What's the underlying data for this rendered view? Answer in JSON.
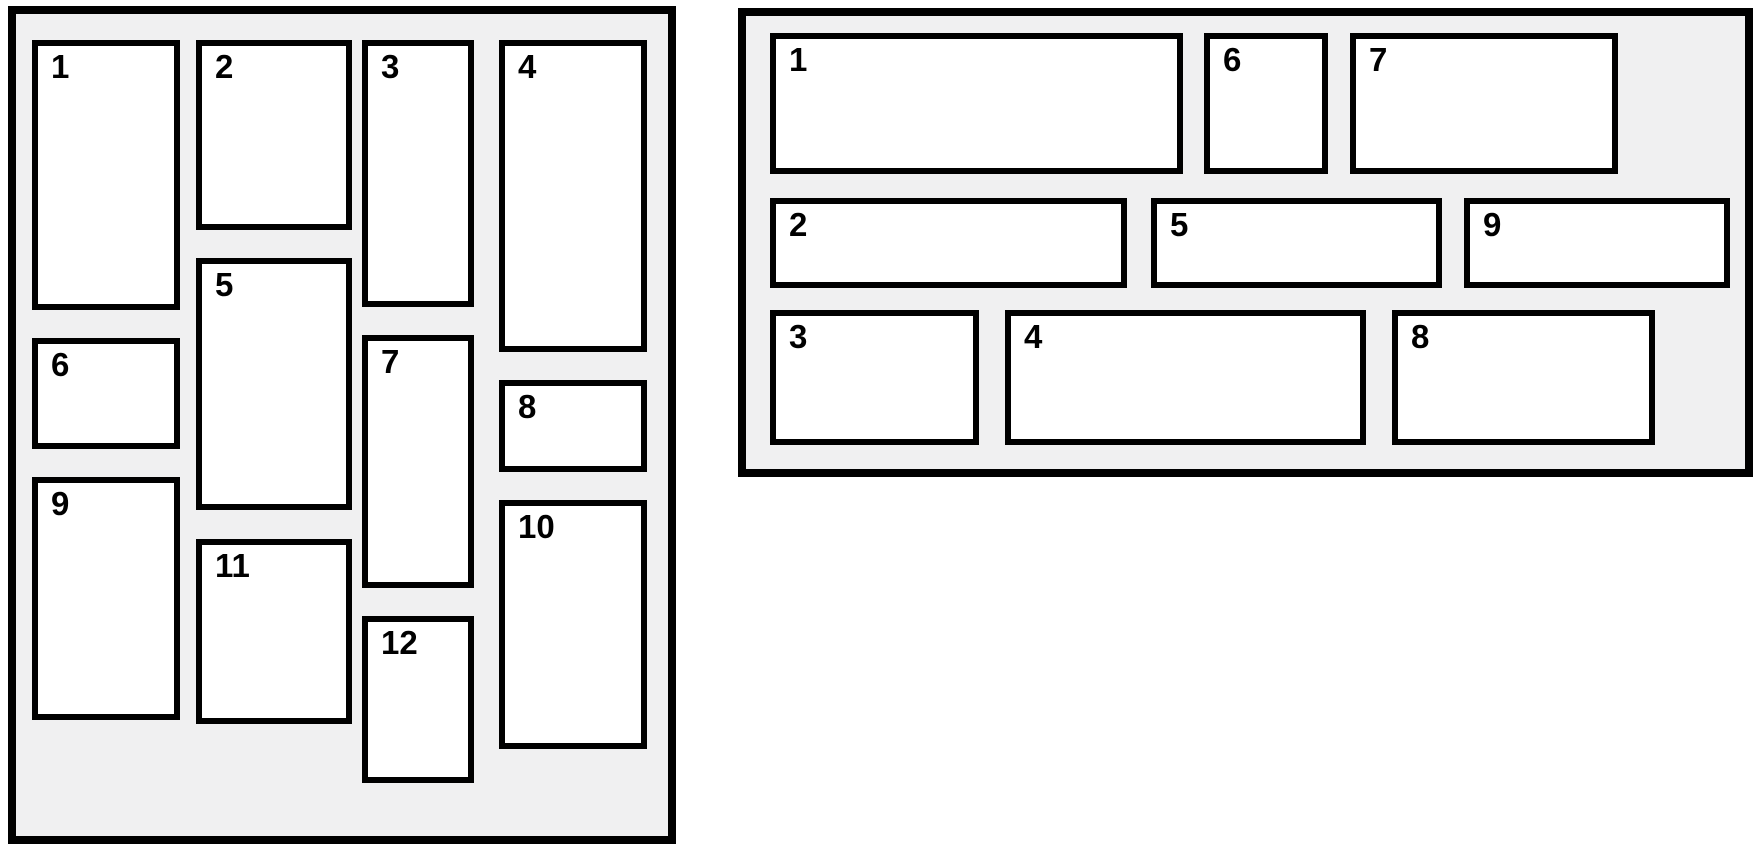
{
  "figure": {
    "page_background": "#ffffff",
    "panel_background": "#f0f0f1",
    "border_color": "#000000",
    "box_background": "#ffffff",
    "label_color": "#000000"
  },
  "panels": [
    {
      "name": "column-masonry-panel",
      "x": 8,
      "y": 6,
      "w": 668,
      "h": 838,
      "border_px": 8,
      "items": [
        {
          "label": "1",
          "x": 32,
          "y": 40,
          "w": 148,
          "h": 270
        },
        {
          "label": "2",
          "x": 196,
          "y": 40,
          "w": 156,
          "h": 190
        },
        {
          "label": "3",
          "x": 362,
          "y": 40,
          "w": 112,
          "h": 267
        },
        {
          "label": "4",
          "x": 499,
          "y": 40,
          "w": 148,
          "h": 312
        },
        {
          "label": "5",
          "x": 196,
          "y": 258,
          "w": 156,
          "h": 252
        },
        {
          "label": "6",
          "x": 32,
          "y": 338,
          "w": 148,
          "h": 111
        },
        {
          "label": "7",
          "x": 362,
          "y": 335,
          "w": 112,
          "h": 253
        },
        {
          "label": "8",
          "x": 499,
          "y": 380,
          "w": 148,
          "h": 92
        },
        {
          "label": "9",
          "x": 32,
          "y": 477,
          "w": 148,
          "h": 243
        },
        {
          "label": "10",
          "x": 499,
          "y": 500,
          "w": 148,
          "h": 249
        },
        {
          "label": "11",
          "x": 196,
          "y": 539,
          "w": 156,
          "h": 185
        },
        {
          "label": "12",
          "x": 362,
          "y": 616,
          "w": 112,
          "h": 167
        }
      ]
    },
    {
      "name": "row-masonry-panel",
      "x": 738,
      "y": 8,
      "w": 1015,
      "h": 469,
      "border_px": 8,
      "items": [
        {
          "label": "1",
          "x": 770,
          "y": 33,
          "w": 413,
          "h": 141
        },
        {
          "label": "2",
          "x": 770,
          "y": 198,
          "w": 357,
          "h": 90
        },
        {
          "label": "3",
          "x": 770,
          "y": 310,
          "w": 209,
          "h": 135
        },
        {
          "label": "4",
          "x": 1005,
          "y": 310,
          "w": 361,
          "h": 135
        },
        {
          "label": "5",
          "x": 1151,
          "y": 198,
          "w": 291,
          "h": 90
        },
        {
          "label": "6",
          "x": 1204,
          "y": 33,
          "w": 124,
          "h": 141
        },
        {
          "label": "7",
          "x": 1350,
          "y": 33,
          "w": 268,
          "h": 141
        },
        {
          "label": "8",
          "x": 1392,
          "y": 310,
          "w": 263,
          "h": 135
        },
        {
          "label": "9",
          "x": 1464,
          "y": 198,
          "w": 266,
          "h": 90
        }
      ]
    }
  ]
}
